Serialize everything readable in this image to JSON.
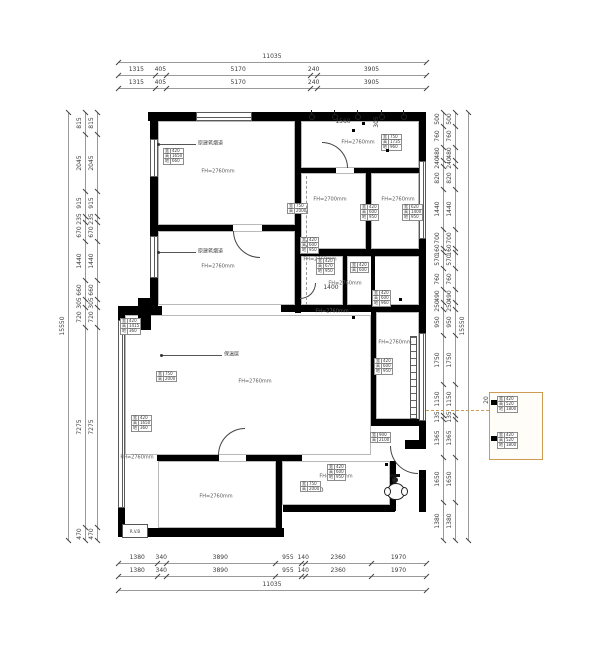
{
  "drawing": {
    "fridge_label": "R.V.B",
    "chains": [
      {
        "o": "h",
        "x1": 118,
        "x2": 426,
        "y": 62,
        "v": [
          11035
        ]
      },
      {
        "o": "h",
        "x1": 118,
        "x2": 426,
        "y": 75,
        "v": [
          1315,
          405,
          5170,
          240,
          3905
        ]
      },
      {
        "o": "h",
        "x1": 118,
        "x2": 426,
        "y": 88,
        "v": [
          1315,
          405,
          5170,
          240,
          3905
        ]
      },
      {
        "o": "h",
        "x1": 118,
        "x2": 426,
        "y": 563,
        "v": [
          1380,
          340,
          3890,
          955,
          140,
          2360,
          1970
        ]
      },
      {
        "o": "h",
        "x1": 118,
        "x2": 426,
        "y": 576,
        "v": [
          1380,
          340,
          3890,
          955,
          140,
          2360,
          1970
        ]
      },
      {
        "o": "h",
        "x1": 118,
        "x2": 426,
        "y": 590,
        "v": [
          11035
        ]
      },
      {
        "o": "v",
        "x": 68,
        "y1": 112,
        "y2": 540,
        "v": [
          15550
        ]
      },
      {
        "o": "v",
        "x": 85,
        "y1": 112,
        "y2": 540,
        "v": [
          815,
          2045,
          915,
          235,
          670,
          1440,
          660,
          305,
          720,
          7275,
          470
        ]
      },
      {
        "o": "v",
        "x": 97,
        "y1": 112,
        "y2": 540,
        "v": [
          815,
          2045,
          915,
          235,
          670,
          1440,
          660,
          305,
          720,
          7275,
          470
        ]
      },
      {
        "o": "v",
        "x": 443,
        "y1": 112,
        "y2": 540,
        "v": [
          500,
          760,
          480,
          240,
          820,
          1440,
          700,
          160,
          570,
          760,
          490,
          250,
          950,
          1750,
          1150,
          135,
          1365,
          1650,
          1380
        ]
      },
      {
        "o": "v",
        "x": 455,
        "y1": 112,
        "y2": 540,
        "v": [
          500,
          760,
          480,
          240,
          820,
          1440,
          700,
          160,
          570,
          760,
          490,
          250,
          950,
          1750,
          1150,
          135,
          1365,
          1650,
          1380
        ]
      },
      {
        "o": "v",
        "x": 468,
        "y1": 112,
        "y2": 540,
        "v": [
          15550
        ]
      }
    ],
    "rooms": [
      {
        "x": 218,
        "y": 172,
        "t": "FH=2760mm"
      },
      {
        "x": 358,
        "y": 143,
        "t": "FH=2760mm"
      },
      {
        "x": 330,
        "y": 200,
        "t": "FH=2700mm"
      },
      {
        "x": 398,
        "y": 200,
        "t": "FH=2760mm"
      },
      {
        "x": 218,
        "y": 267,
        "t": "FH=2760mm"
      },
      {
        "x": 320,
        "y": 260,
        "t": "FH=2760mm"
      },
      {
        "x": 345,
        "y": 284,
        "t": "FH=2760mm"
      },
      {
        "x": 332,
        "y": 312,
        "t": "FH=2760mm"
      },
      {
        "x": 395,
        "y": 343,
        "t": "FH=2760mm"
      },
      {
        "x": 255,
        "y": 382,
        "t": "FH=2760mm"
      },
      {
        "x": 137,
        "y": 458,
        "t": "FH=2760mm"
      },
      {
        "x": 216,
        "y": 497,
        "t": "FH=2760mm"
      },
      {
        "x": 336,
        "y": 477,
        "t": "FH=2760mm"
      }
    ],
    "free_labels": [
      {
        "x": 343,
        "y": 122,
        "t": "1560",
        "r": 0
      },
      {
        "x": 377,
        "y": 122,
        "t": "305",
        "r": -90
      },
      {
        "x": 331,
        "y": 288,
        "t": "1400",
        "r": 0
      },
      {
        "x": 316,
        "y": 491,
        "t": "1140",
        "r": 0
      },
      {
        "x": 487,
        "y": 400,
        "t": "20",
        "r": -90
      }
    ],
    "leaders": [
      {
        "x1": 158,
        "y1": 144,
        "x2": 196,
        "y2": 144,
        "tx": 198,
        "ty": 144,
        "t": "原建筑烟道"
      },
      {
        "x1": 158,
        "y1": 252,
        "x2": 196,
        "y2": 252,
        "tx": 198,
        "ty": 252,
        "t": "原建筑烟道"
      },
      {
        "x1": 161,
        "y1": 355,
        "x2": 222,
        "y2": 355,
        "tx": 224,
        "ty": 355,
        "t": "保温层"
      }
    ],
    "tables": [
      {
        "x": 163,
        "y": 148,
        "rows": [
          [
            "宽",
            "420"
          ],
          [
            "高",
            "1650"
          ],
          [
            "地",
            "660"
          ]
        ]
      },
      {
        "x": 381,
        "y": 134,
        "rows": [
          [
            "宽",
            "750"
          ],
          [
            "高",
            "1735"
          ],
          [
            "地",
            "960"
          ]
        ]
      },
      {
        "x": 287,
        "y": 203,
        "rows": [
          [
            "宽",
            "750"
          ],
          [
            "高",
            "2000"
          ]
        ]
      },
      {
        "x": 300,
        "y": 237,
        "rows": [
          [
            "宽",
            "420"
          ],
          [
            "高",
            "600"
          ],
          [
            "地",
            "950"
          ]
        ]
      },
      {
        "x": 360,
        "y": 204,
        "rows": [
          [
            "宽",
            "420"
          ],
          [
            "高",
            "600"
          ],
          [
            "地",
            "950"
          ]
        ]
      },
      {
        "x": 402,
        "y": 204,
        "rows": [
          [
            "宽",
            "620"
          ],
          [
            "高",
            "1400"
          ],
          [
            "地",
            "950"
          ]
        ]
      },
      {
        "x": 316,
        "y": 258,
        "rows": [
          [
            "宽",
            "420"
          ],
          [
            "高",
            "670"
          ],
          [
            "地",
            "950"
          ]
        ]
      },
      {
        "x": 350,
        "y": 262,
        "rows": [
          [
            "宽",
            "420"
          ],
          [
            "高",
            "600"
          ]
        ]
      },
      {
        "x": 372,
        "y": 290,
        "rows": [
          [
            "宽",
            "420"
          ],
          [
            "高",
            "600"
          ],
          [
            "地",
            "960"
          ]
        ]
      },
      {
        "x": 120,
        "y": 318,
        "rows": [
          [
            "宽",
            "420"
          ],
          [
            "高",
            "1415"
          ],
          [
            "地",
            "360"
          ]
        ]
      },
      {
        "x": 156,
        "y": 371,
        "rows": [
          [
            "宽",
            "750"
          ],
          [
            "高",
            "2000"
          ]
        ]
      },
      {
        "x": 131,
        "y": 415,
        "rows": [
          [
            "宽",
            "420"
          ],
          [
            "高",
            "1650"
          ],
          [
            "地",
            "360"
          ]
        ]
      },
      {
        "x": 374,
        "y": 358,
        "rows": [
          [
            "宽",
            "420"
          ],
          [
            "高",
            "600"
          ],
          [
            "地",
            "950"
          ]
        ]
      },
      {
        "x": 370,
        "y": 432,
        "rows": [
          [
            "宽",
            "900"
          ],
          [
            "高",
            "2100"
          ]
        ]
      },
      {
        "x": 327,
        "y": 464,
        "rows": [
          [
            "宽",
            "420"
          ],
          [
            "高",
            "600"
          ],
          [
            "地",
            "950"
          ]
        ]
      },
      {
        "x": 300,
        "y": 481,
        "rows": [
          [
            "宽",
            "750"
          ],
          [
            "高",
            "2000"
          ]
        ]
      }
    ],
    "legend": {
      "x": 489,
      "y": 392,
      "w": 52,
      "h": 66,
      "tables": [
        {
          "x": 497,
          "y": 396,
          "rows": [
            [
              "宽",
              "420"
            ],
            [
              "高",
              "520"
            ],
            [
              "地",
              "1800"
            ]
          ]
        },
        {
          "x": 497,
          "y": 432,
          "rows": [
            [
              "宽",
              "420"
            ],
            [
              "高",
              "520"
            ],
            [
              "地",
              "1800"
            ]
          ]
        }
      ],
      "handles": [
        [
          491,
          400,
          6,
          5
        ],
        [
          491,
          436,
          6,
          5
        ]
      ]
    },
    "geometry": {
      "walls": [
        [
          148,
          112,
          48,
          9
        ],
        [
          252,
          112,
          174,
          9
        ],
        [
          150,
          112,
          8,
          27
        ],
        [
          150,
          177,
          8,
          59
        ],
        [
          150,
          278,
          8,
          35
        ],
        [
          419,
          112,
          7,
          49
        ],
        [
          419,
          239,
          7,
          94
        ],
        [
          419,
          421,
          7,
          24
        ],
        [
          419,
          470,
          7,
          42
        ],
        [
          157,
          225,
          76,
          6
        ],
        [
          262,
          225,
          39,
          6
        ],
        [
          295,
          120,
          6,
          106
        ],
        [
          295,
          231,
          6,
          82
        ],
        [
          300,
          168,
          36,
          5
        ],
        [
          354,
          168,
          71,
          5
        ],
        [
          366,
          173,
          5,
          76
        ],
        [
          300,
          249,
          126,
          7
        ],
        [
          343,
          256,
          4,
          50
        ],
        [
          371,
          256,
          4,
          50
        ],
        [
          281,
          305,
          145,
          7
        ],
        [
          118,
          306,
          44,
          9
        ],
        [
          371,
          312,
          5,
          109
        ],
        [
          371,
          419,
          55,
          7
        ],
        [
          157,
          455,
          62,
          6
        ],
        [
          246,
          455,
          56,
          6
        ],
        [
          276,
          461,
          6,
          74
        ],
        [
          118,
          528,
          166,
          9
        ],
        [
          283,
          505,
          112,
          7
        ],
        [
          390,
          461,
          6,
          50
        ],
        [
          118,
          306,
          7,
          14
        ],
        [
          118,
          508,
          7,
          28
        ],
        [
          138,
          298,
          13,
          32
        ],
        [
          127,
          306,
          25,
          9
        ],
        [
          405,
          440,
          21,
          9
        ]
      ],
      "outlines": [
        [
          158,
          121,
          137,
          104
        ],
        [
          301,
          121,
          118,
          47
        ],
        [
          301,
          173,
          65,
          76
        ],
        [
          371,
          173,
          48,
          76
        ],
        [
          158,
          231,
          137,
          74
        ],
        [
          301,
          256,
          42,
          49
        ],
        [
          347,
          256,
          72,
          49
        ],
        [
          376,
          312,
          43,
          107
        ],
        [
          125,
          315,
          246,
          140
        ],
        [
          158,
          461,
          118,
          67
        ],
        [
          282,
          461,
          108,
          44
        ]
      ],
      "windows": [
        {
          "x": 196,
          "y": 112,
          "w": 56,
          "h": 9,
          "o": "h"
        },
        {
          "x": 150,
          "y": 139,
          "w": 8,
          "h": 38,
          "o": "v"
        },
        {
          "x": 150,
          "y": 236,
          "w": 8,
          "h": 42,
          "o": "v"
        },
        {
          "x": 419,
          "y": 161,
          "w": 7,
          "h": 78,
          "o": "v"
        },
        {
          "x": 419,
          "y": 333,
          "w": 7,
          "h": 88,
          "o": "v"
        },
        {
          "x": 118,
          "y": 320,
          "w": 7,
          "h": 188,
          "o": "v"
        }
      ],
      "arcs": [
        {
          "x": 390,
          "y": 446,
          "s": 28,
          "type": "bl"
        },
        {
          "x": 233,
          "y": 231,
          "s": 27,
          "type": "bl"
        },
        {
          "x": 322,
          "y": 142,
          "s": 26,
          "type": "tr"
        },
        {
          "x": 218,
          "y": 428,
          "s": 27,
          "type": "tl"
        },
        {
          "x": 300,
          "y": 283,
          "s": 16,
          "type": "br"
        }
      ],
      "dashes": [
        {
          "x": 306,
          "y": 176,
          "w": 1,
          "h": 72,
          "c": "#999999"
        },
        {
          "x": 306,
          "y": 257,
          "w": 1,
          "h": 48,
          "c": "#999999"
        },
        {
          "x": 426,
          "y": 410,
          "w": 63,
          "h": 1,
          "c": "#cf9a52"
        }
      ],
      "ladder": {
        "x": 410,
        "y": 336,
        "w": 7,
        "h": 83
      },
      "lights": [
        [
          311,
          116
        ],
        [
          334,
          116
        ],
        [
          357,
          116
        ],
        [
          381,
          116
        ],
        [
          403,
          116
        ]
      ],
      "dots": [
        [
          352,
          129
        ],
        [
          386,
          149
        ],
        [
          399,
          298
        ],
        [
          352,
          316
        ],
        [
          385,
          463
        ],
        [
          362,
          122
        ]
      ]
    }
  }
}
